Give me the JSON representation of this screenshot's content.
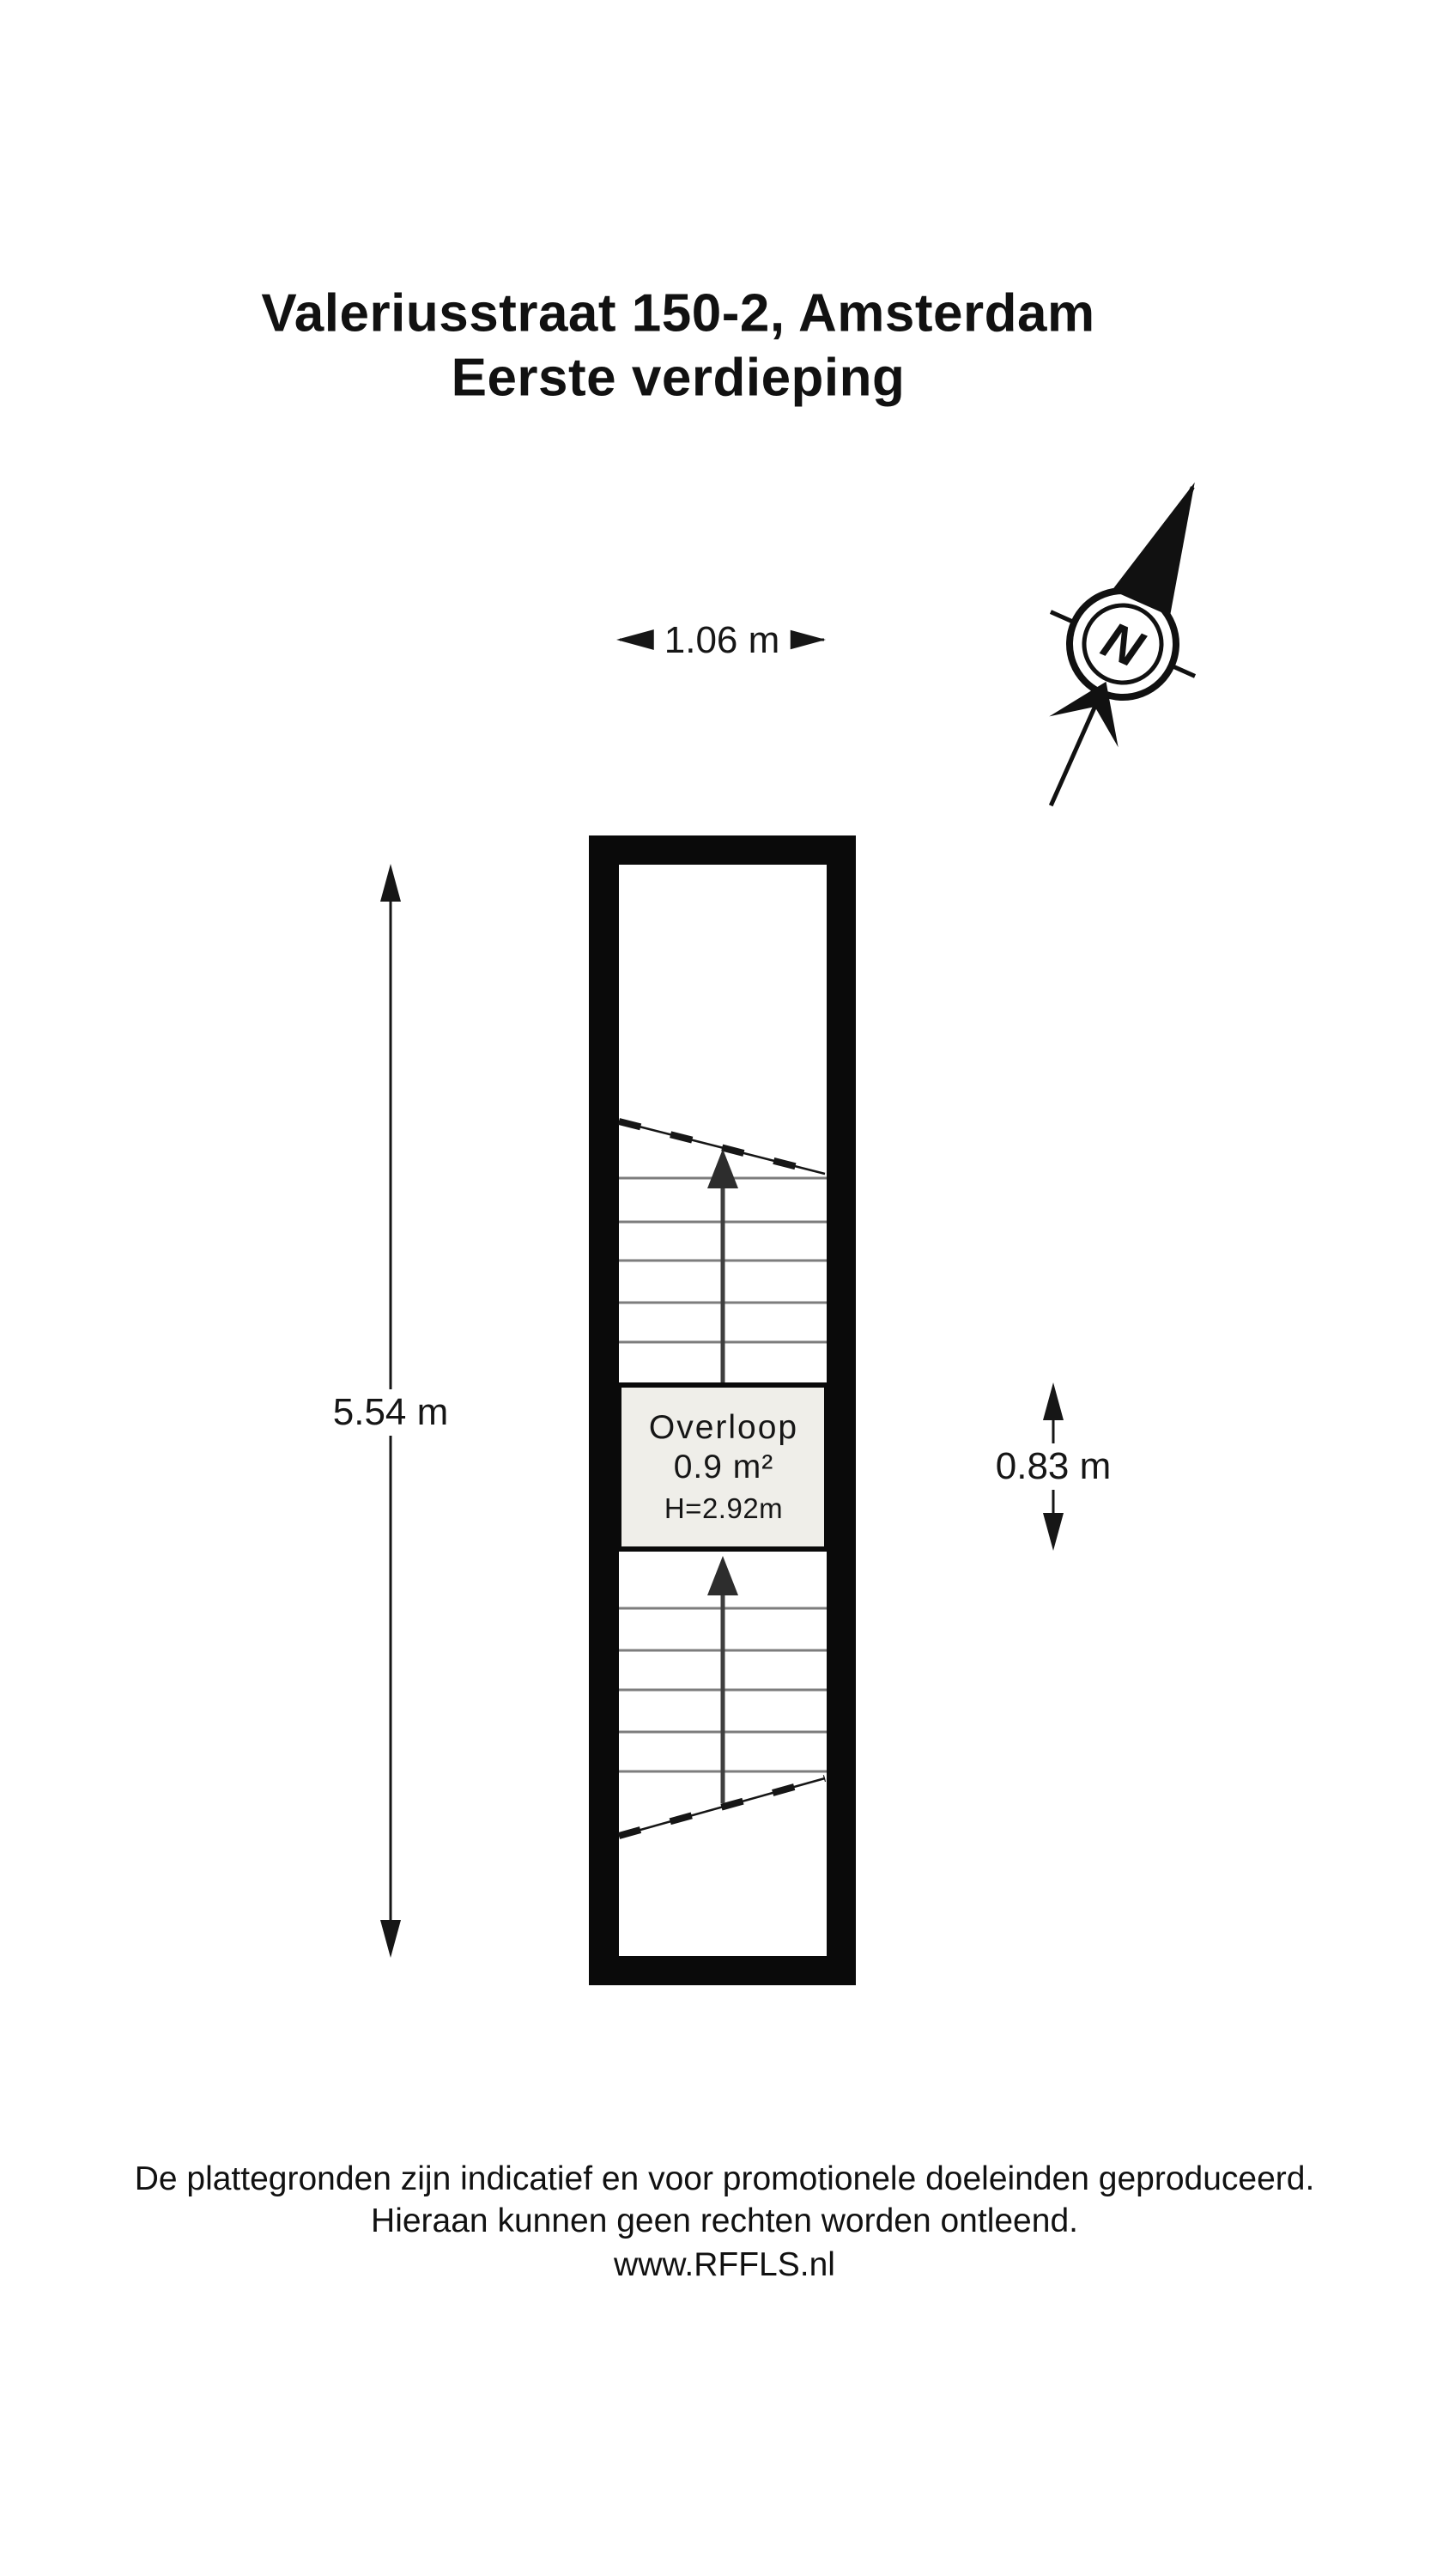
{
  "title": {
    "line1": "Valeriusstraat 150-2, Amsterdam",
    "line2": "Eerste verdieping"
  },
  "compass": {
    "letter": "N"
  },
  "dimensions": {
    "plan_width": "1.06 m",
    "plan_height": "5.54 m",
    "landing_depth": "0.83 m"
  },
  "room": {
    "name": "Overloop",
    "area": "0.9 m²",
    "ceiling_height": "H=2.92m"
  },
  "footer": {
    "line1": "De plattegronden zijn indicatief en voor promotionele doeleinden geproduceerd.",
    "line2": "Hieraan kunnen geen rechten worden ontleend.",
    "line3": "www.RFFLS.nl"
  },
  "colors": {
    "ink": "#111111",
    "wall": "#0a0a0a",
    "floor": "#ffffff",
    "landing_fill": "#efeee9",
    "tread_gray": "#7d7d7d",
    "walkline_gray": "#3f3f3f"
  }
}
